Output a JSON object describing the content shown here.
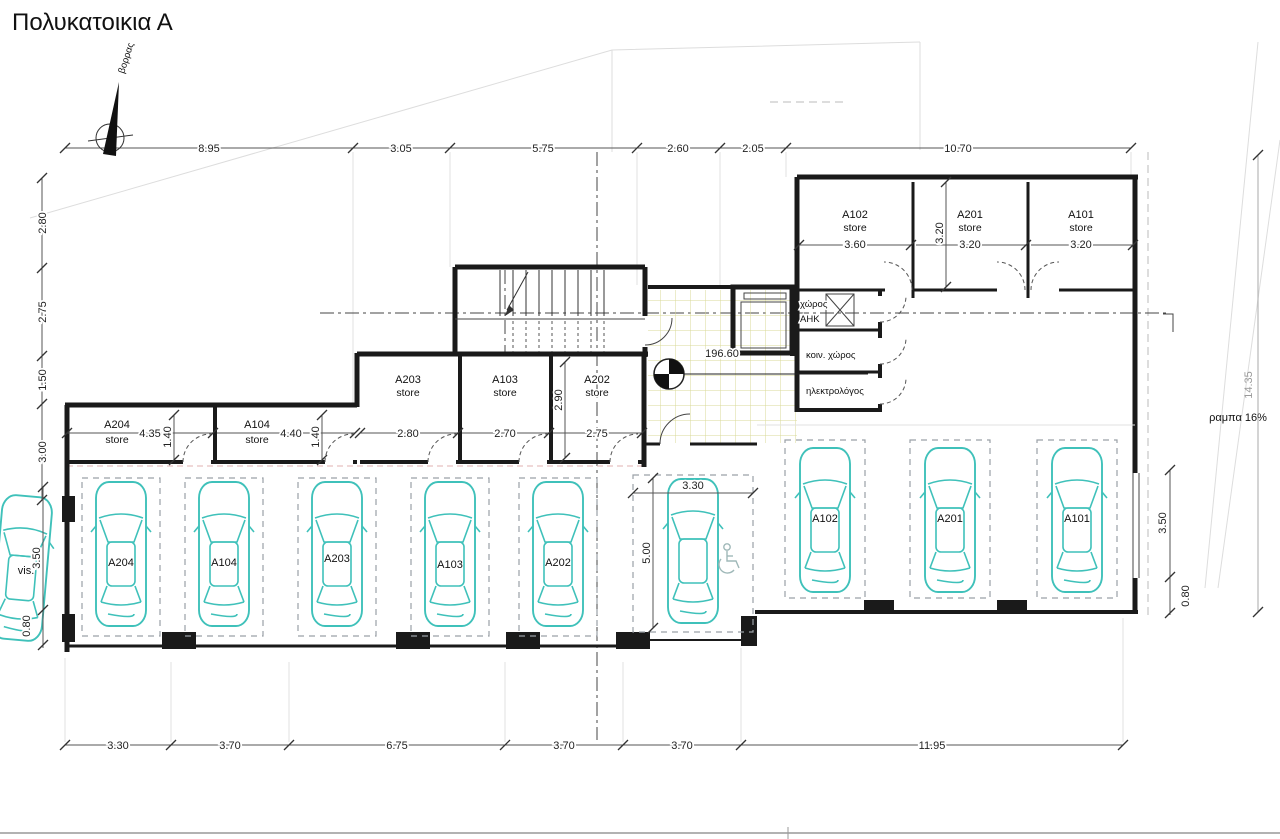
{
  "title": "Πολυκατοικια Α",
  "north": {
    "label": "βορρας"
  },
  "dims": {
    "top": [
      "8.95",
      "3.05",
      "5.75",
      "2.60",
      "2.05",
      "10.70"
    ],
    "left": [
      "2.80",
      "2.75",
      "1.50",
      "3.00"
    ],
    "bottom": [
      "3.30",
      "3.70",
      "6.75",
      "3.70",
      "3.70",
      "11.95"
    ],
    "right": [
      "14.35",
      "3.50",
      "0.80"
    ],
    "visitor": [
      "3.50",
      "0.80"
    ],
    "accessible": [
      "3.30",
      "5.00"
    ]
  },
  "stores": {
    "word": "store",
    "top_row": [
      {
        "id": "A102",
        "w": "3.60"
      },
      {
        "id": "A201",
        "w": "3.20",
        "d": "3.20"
      },
      {
        "id": "A101",
        "w": "3.20"
      }
    ],
    "mid_row": [
      {
        "id": "A203",
        "w": "2.80"
      },
      {
        "id": "A103",
        "w": "2.70"
      },
      {
        "id": "A202",
        "w": "2.75",
        "d": "2.90"
      }
    ],
    "left_row": [
      {
        "id": "A204",
        "w": "4.35",
        "d": "1.40"
      },
      {
        "id": "A104",
        "w": "4.40",
        "d": "1.40"
      }
    ]
  },
  "utility": {
    "room1_line1": "χώρος",
    "room1_line2": "ΑΗΚ",
    "room2": "κοιν. χώρος",
    "room3": "ηλεκτρολόγος"
  },
  "parking": {
    "left_row": [
      "A204",
      "A104",
      "A203",
      "A103",
      "A202"
    ],
    "right_row": [
      "A102",
      "A201",
      "A101"
    ],
    "visitor_label": "vis."
  },
  "annotations": {
    "level": "196.60",
    "ramp": "ραμπα 16%"
  },
  "colors": {
    "wall": "#1a1a1a",
    "car": "#3fc1ba",
    "tile": "#d9d997"
  }
}
